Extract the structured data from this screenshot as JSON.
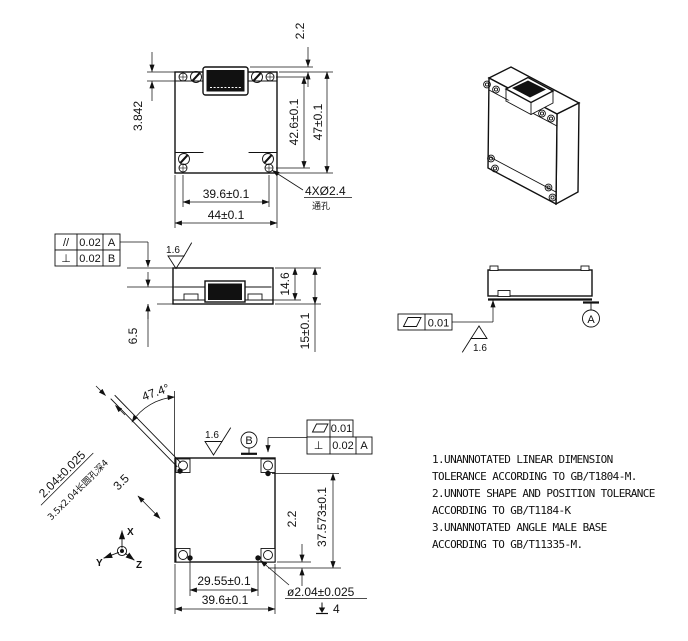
{
  "front_view": {
    "dim_connector_protrusion": "2.2",
    "dim_screw_offset": "3.842",
    "dim_hole_span_v": "42.6±0.1",
    "dim_height": "47±0.1",
    "dim_hole_span_h": "39.6±0.1",
    "dim_width": "44±0.1",
    "hole_callout": "4XØ2.4",
    "hole_callout_note": "通孔"
  },
  "side_view": {
    "fcf": [
      {
        "symbol": "//",
        "value": "0.02",
        "datum": "A"
      },
      {
        "symbol": "⊥",
        "value": "0.02",
        "datum": "B"
      }
    ],
    "roughness": "1.6",
    "dim_body_height": "14.6",
    "dim_total_height": "15±0.1",
    "dim_connector_depth": "6.5"
  },
  "right_view": {
    "fcf_value": "0.01",
    "roughness": "1.6",
    "datum_label": "A"
  },
  "bottom_view": {
    "roughness": "1.6",
    "datum_label": "B",
    "fcf": [
      {
        "value": "0.01"
      },
      {
        "symbol": "⊥",
        "value": "0.02",
        "datum": "A"
      }
    ],
    "dim_angle": "47.4°",
    "dim_slot_width": "2.04±0.025",
    "slot_note": "3.5x2.04长圆孔深4",
    "dim_slot_length": "3.5",
    "dim_pin_offset": "2.2",
    "dim_pin_span_v": "37.573±0.1",
    "dim_pin_span_h": "29.55±0.1",
    "dim_width": "39.6±0.1",
    "pin_callout": "ø2.04±0.025",
    "pin_depth": "4"
  },
  "axes": {
    "x": "X",
    "y": "Y",
    "z": "Z"
  },
  "notes": {
    "lines": [
      "1.UNANNOTATED LINEAR DIMENSION",
      "TOLERANCE ACCORDING TO GB/T1804-M.",
      "2.UNNOTE SHAPE AND POSITION TOLERANCE",
      "ACCORDING TO GB/T1184-K",
      "3.UNANNOTATED ANGLE MALE BASE",
      "ACCORDING TO GB/T11335-M."
    ]
  }
}
